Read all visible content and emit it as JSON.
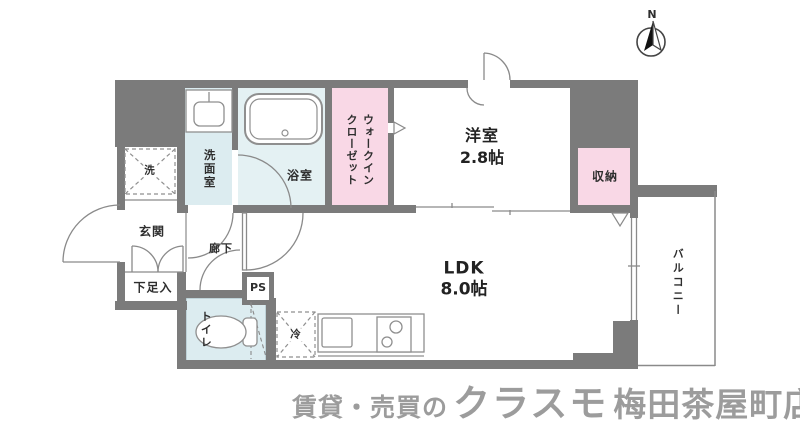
{
  "floorplan": {
    "rooms": {
      "western_room": {
        "name": "洋室",
        "size": "2.8帖"
      },
      "ldk": {
        "name": "LDK",
        "size": "8.0帖"
      },
      "walk_in_closet": "ウォークイン\nクローゼット",
      "storage": "収納",
      "bathroom": "浴室",
      "washroom": "洗面室",
      "toilet": "トイレ",
      "entrance": "玄関",
      "hallway": "廊下",
      "shoe_box": "下足入",
      "pipe_space": "PS",
      "balcony": "バルコニー",
      "washer": "洗",
      "fridge": "冷"
    },
    "compass_north": "N"
  },
  "footer": {
    "prefix": "賃貸・売買の",
    "brand": "クラスモ",
    "branch": "梅田茶屋町店"
  },
  "colors": {
    "wall": "#7b7b7b",
    "room_pink": "#f9d8e6",
    "room_blue": "#dcecf0",
    "bath_blue": "#e4f1f3",
    "line": "#8a8a8a",
    "logo_gray": "#9c9c9c"
  }
}
